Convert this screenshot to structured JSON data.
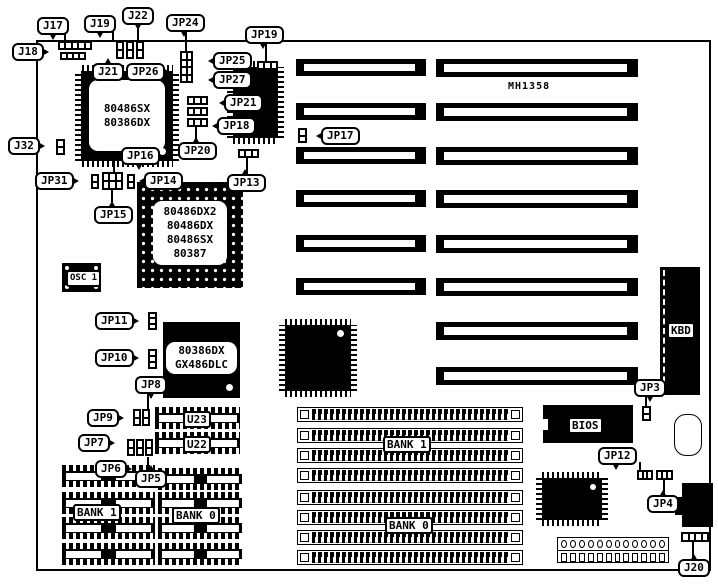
{
  "board": {
    "model": "MH1358"
  },
  "colors": {
    "ink": "#000000",
    "paper": "#ffffff"
  },
  "callouts": {
    "j17": "J17",
    "j18": "J18",
    "j19": "J19",
    "j20": "J20",
    "j21": "J21",
    "j22": "J22",
    "j32": "J32",
    "jp3": "JP3",
    "jp4": "JP4",
    "jp5": "JP5",
    "jp6": "JP6",
    "jp7": "JP7",
    "jp8": "JP8",
    "jp9": "JP9",
    "jp10": "JP10",
    "jp11": "JP11",
    "jp12": "JP12",
    "jp13": "JP13",
    "jp14": "JP14",
    "jp15": "JP15",
    "jp16": "JP16",
    "jp17": "JP17",
    "jp18": "JP18",
    "jp19": "JP19",
    "jp20": "JP20",
    "jp21": "JP21",
    "jp24": "JP24",
    "jp25": "JP25",
    "jp26": "JP26",
    "jp27": "JP27",
    "jp31": "JP31",
    "osc1": "OSC 1",
    "u23": "U23",
    "u22": "U22",
    "bank1": "BANK 1",
    "bank0": "BANK 0",
    "bios": "BIOS",
    "kbd": "KBD"
  },
  "chips": {
    "qfp_cpu": {
      "line1": "80486SX",
      "line2": "80386DX"
    },
    "pga_cpu": {
      "line1": "80486DX2",
      "line2": "80486DX",
      "line3": "80486SX",
      "line4": "80387"
    },
    "dlc": {
      "line1": "80386DX",
      "line2": "GX486DLC"
    }
  }
}
